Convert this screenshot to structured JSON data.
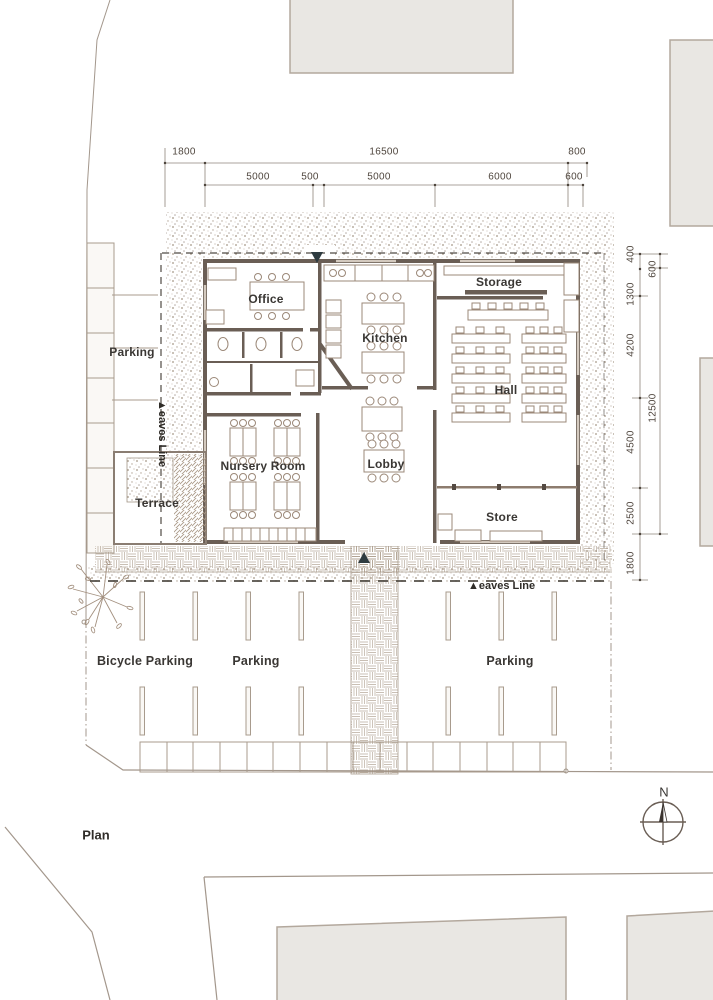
{
  "title": {
    "plan_label": "Plan"
  },
  "compass": {
    "north_label": "N"
  },
  "rooms": {
    "office": "Office",
    "kitchen": "Kitchen",
    "storage": "Storage",
    "hall": "Hall",
    "nursery": "Nursery Room",
    "lobby": "Lobby",
    "store": "Store",
    "terrace": "Terrace",
    "parking_west": "Parking"
  },
  "site": {
    "bicycle_parking": "Bicycle Parking",
    "parking_center": "Parking",
    "parking_east": "Parking",
    "eaves_line_west": "▲eaves Line",
    "eaves_line_south": "▲eaves Line"
  },
  "dimensions": {
    "top_primary": [
      "1800",
      "16500",
      "800"
    ],
    "top_secondary": [
      "5000",
      "500",
      "5000",
      "6000",
      "600"
    ],
    "right_inner": [
      "400",
      "1300",
      "4200",
      "4500",
      "2500",
      "1800"
    ],
    "right_outer": [
      "600",
      "12500"
    ]
  },
  "colors": {
    "wall": "#6a5e55",
    "linework": "#9b8d80",
    "stipple": "#8d7a68",
    "neighbor_fill": "#e9e7e3",
    "label_text": "#3a3734"
  }
}
